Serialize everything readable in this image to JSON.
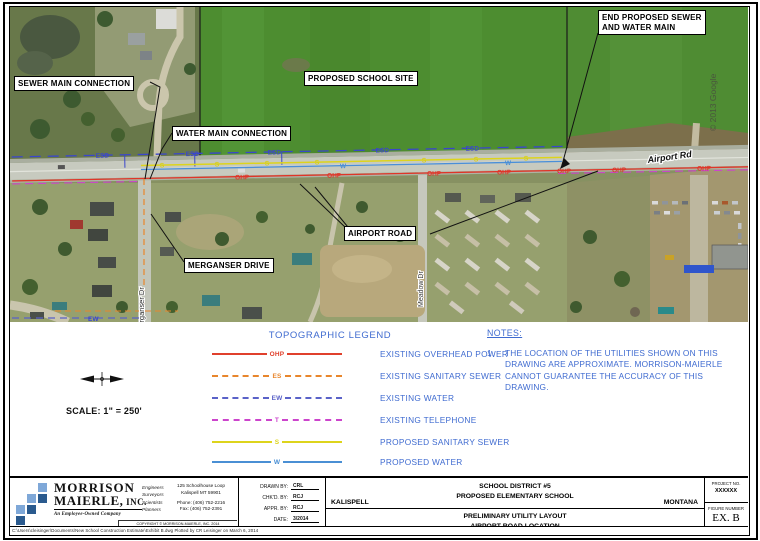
{
  "map": {
    "labels": {
      "sewer_main_connection": "SEWER MAIN CONNECTION",
      "water_main_connection": "WATER MAIN CONNECTION",
      "proposed_school_site": "PROPOSED SCHOOL SITE",
      "end_proposed_line1": "END PROPOSED SEWER",
      "end_proposed_line2": "AND WATER MAIN",
      "airport_road": "AIRPORT ROAD",
      "merganser_drive": "MERGANSER DRIVE"
    },
    "street_names": {
      "merganser": "Merganser Dr",
      "meadow": "Meadow Dr",
      "airport_rd": "Airport Rd"
    },
    "google_credit": "© 2013 Google",
    "line_labels": {
      "esd": "ESD",
      "s": "S",
      "w": "W",
      "ohp": "OHP",
      "ew": "EW"
    }
  },
  "legend": {
    "title": "TOPOGRAPHIC LEGEND",
    "items": [
      {
        "code": "OHP",
        "desc": "EXISTING OVERHEAD POWER",
        "color": "#e0402c",
        "style": "solid"
      },
      {
        "code": "ES",
        "desc": "EXISTING SANITARY SEWER",
        "color": "#e8862c",
        "style": "dashed"
      },
      {
        "code": "EW",
        "desc": "EXISTING WATER",
        "color": "#5a62c8",
        "style": "dashed"
      },
      {
        "code": "T",
        "desc": "EXISTING TELEPHONE",
        "color": "#cc44cc",
        "style": "dashed"
      },
      {
        "code": "S",
        "desc": "PROPOSED SANITARY SEWER",
        "color": "#ddd41c",
        "style": "solid"
      },
      {
        "code": "W",
        "desc": "PROPOSED WATER",
        "color": "#4a8fd4",
        "style": "solid"
      }
    ]
  },
  "notes": {
    "title": "NOTES:",
    "item_number": "1.",
    "body": "THE LOCATION OF THE UTILITIES SHOWN ON THIS DRAWING ARE APPROXIMATE. MORRISON-MAIERLE CANNOT GUARANTEE THE ACCURACY OF THIS DRAWING."
  },
  "scale_text": "SCALE: 1\" = 250'",
  "titleblock": {
    "firm": {
      "name_line1": "MORRISON",
      "name_line2": "MAIERLE,",
      "name_suffix": " INC.",
      "tagline": "An Employee-Owned Company",
      "disciplines": [
        "Engineers",
        "Surveyors",
        "Scientists",
        "Planners"
      ],
      "address_line1": "125 Schoolhouse Loop",
      "address_line2": "Kalispell MT 59901",
      "phone": "Phone: (406) 752-2216",
      "fax": "Fax: (406) 752-2391",
      "copyright": "COPYRIGHT © MORRISON-MAIERLE, INC. 2014"
    },
    "fields": [
      {
        "label": "DRAWN BY:",
        "value": "CRL"
      },
      {
        "label": "CHK'D. BY:",
        "value": "RCJ"
      },
      {
        "label": "APPR. BY:",
        "value": "RCJ"
      },
      {
        "label": "DATE:",
        "value": "3/2014"
      }
    ],
    "city": "KALISPELL",
    "project_line1": "SCHOOL DISTRICT #5",
    "project_line2": "PROPOSED ELEMENTARY SCHOOL",
    "state": "MONTANA",
    "sheet_title_line1": "PRELIMINARY UTILITY LAYOUT",
    "sheet_title_line2": "AIRPORT ROAD LOCATION",
    "project_no_label": "PROJECT NO.",
    "project_no": "XXXXXX",
    "figure_label": "FIGURE NUMBER",
    "figure": "EX. B"
  },
  "footer_path": "C:\\Users\\cleisinger\\Documents\\New School Construction Estimate\\Exhibit B.dwg     Plotted by CR Leisinger on March 6, 2014",
  "colors": {
    "annotation_blue": "#3f6bd0",
    "map_label_blue": "#3a46cc"
  }
}
